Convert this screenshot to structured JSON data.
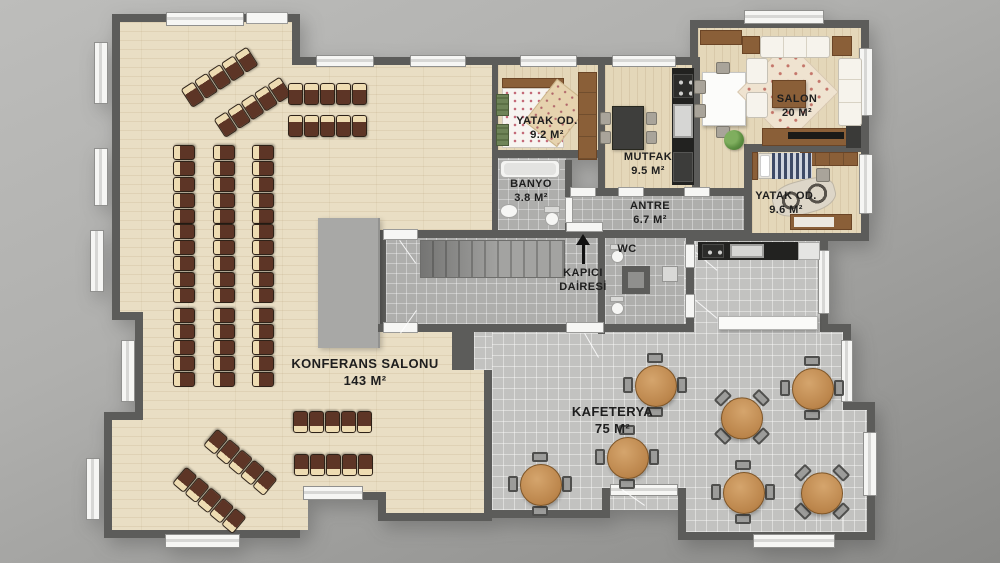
{
  "plan": {
    "rooms": {
      "konferans": {
        "name": "KONFERANS SALONU",
        "area": "143 M²"
      },
      "kafeterya": {
        "name": "KAFETERYA",
        "area": "75 M²"
      },
      "salon": {
        "name": "SALON",
        "area": "20 M²"
      },
      "yatak_od_1": {
        "name": "YATAK OD.",
        "area": "9.2 M²"
      },
      "mutfak": {
        "name": "MUTFAK",
        "area": "9.5 M²"
      },
      "banyo": {
        "name": "BANYO",
        "area": "3.8 M²"
      },
      "antre": {
        "name": "ANTRE",
        "area": "6.7 M²"
      },
      "yatak_od_2": {
        "name": "YATAK OD.",
        "area": "9.6 M²"
      },
      "wc": {
        "name": "WC"
      },
      "kapici_dairesi": {
        "line1": "KAPICI",
        "line2": "DAİRESİ"
      }
    },
    "palette": {
      "wall": "#5c5c5a",
      "conference_floor": "#e9dec4",
      "apartment_floor": "#e4d7b9",
      "corridor_tile": "#aeaeac",
      "cafeteria_tile": "#c2c2c0",
      "conference_chair_seat": "#5d3526",
      "conference_chair_back": "#eedcb2",
      "cafeteria_table": "#c28c54",
      "stage": "#a8a8a6",
      "window": "#f6f6f4",
      "background_top": "#bdbdbb",
      "background_bottom": "#8a8a88"
    }
  }
}
